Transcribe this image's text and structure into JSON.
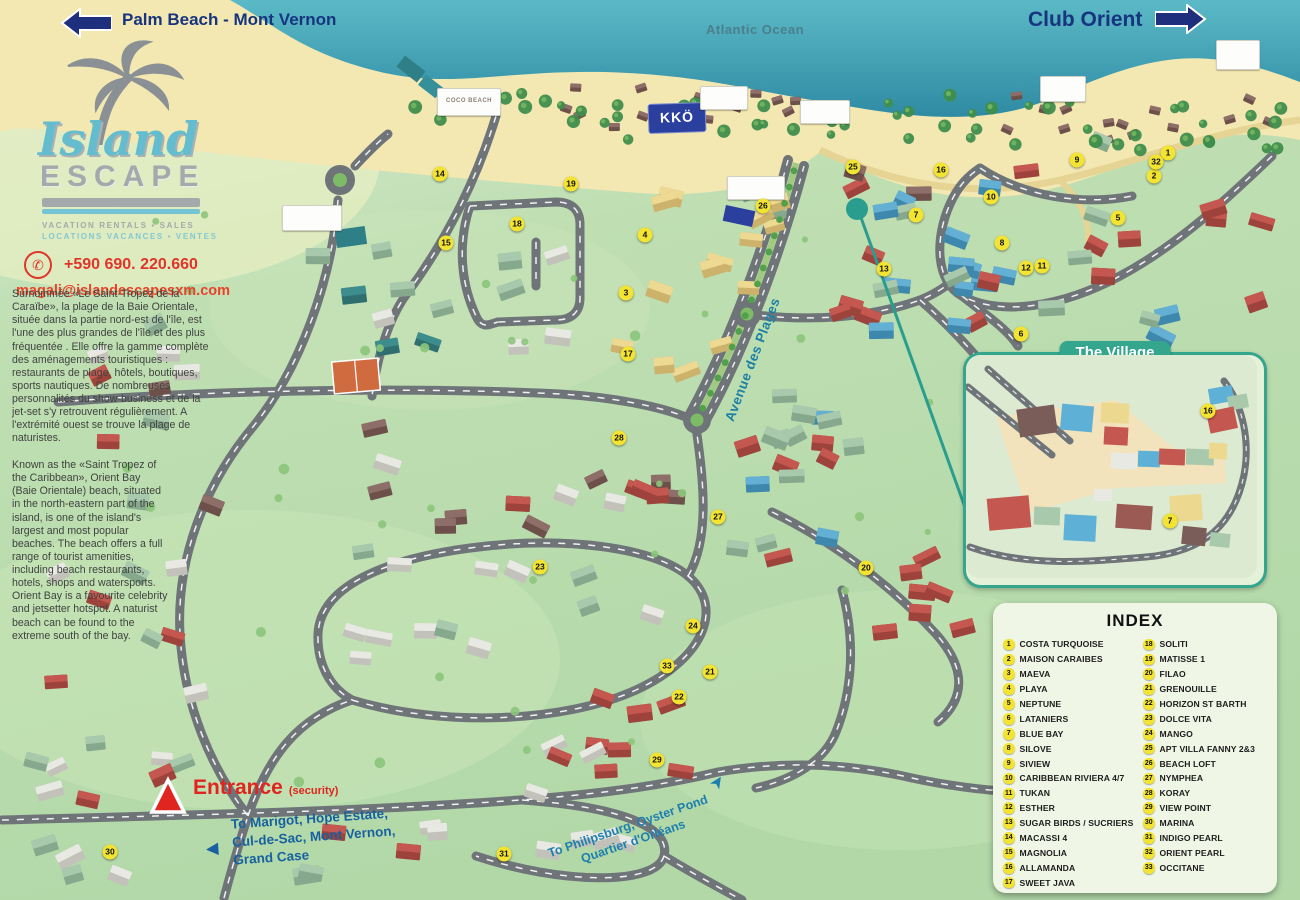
{
  "header": {
    "palm_beach": "Palm Beach - Mont Vernon",
    "atlantic_ocean": "Atlantic Ocean",
    "club_orient": "Club Orient"
  },
  "brand": {
    "name_top": "Island",
    "name_bottom": "ESCAPE",
    "tagline_en": "VACATION RENTALS ▪ SALES",
    "tagline_fr": "LOCATIONS VACANCES ▪ VENTES",
    "phone": "+590 690. 220.660",
    "email": "magali@islandescapesxm.com",
    "description_fr": "Surnommée «Le Saint-Tropez de la Caraïbe», la plage de la Baie Orientale, située dans la partie nord-est de l'île, est l'une des plus grandes de l'île et des plus fréquentée . Elle offre la gamme complète des aménagements touristiques : restaurants de plage, hôtels, boutiques, sports nautiques. De nombreuses personnalités du show-business et de la jet-set s'y retrouvent régulièrement. A l'extrémité ouest se trouve la plage de naturistes.",
    "description_en": "Known as the «Saint Tropez of the Caribbean», Orient Bay (Baie Orientale) beach, situated in the north-eastern part of the island, is one of the island's largest and most popular beaches. The beach offers a full range of tourist amenities, including beach restaurants, hotels, shops and watersports. Orient Bay is a favourite celebrity and jetsetter hotspot. A naturist beach can be found to the extreme south of the bay."
  },
  "map_labels": {
    "avenue": "Avenue des Plages",
    "entrance": "Entrance",
    "security": "(security)",
    "kko_sign": "KKÖ",
    "coco_beach_sign": "COCO BEACH",
    "to_marigot_lines": [
      "To Marigot, Hope Estate,",
      "Cul-de-Sac, Mont Vernon,",
      "Grand Case"
    ],
    "to_philipsburg_lines": [
      "To Philipsburg, Oyster Pond",
      "Quartier d'Orléans"
    ]
  },
  "village": {
    "title": "The Village",
    "markers": [
      {
        "n": 16,
        "x": 1208,
        "y": 411
      },
      {
        "n": 7,
        "x": 1170,
        "y": 521
      }
    ]
  },
  "index": {
    "title": "INDEX",
    "entries": [
      {
        "n": 1,
        "label": "COSTA TURQUOISE"
      },
      {
        "n": 2,
        "label": "MAISON CARAIBES"
      },
      {
        "n": 3,
        "label": "MAEVA"
      },
      {
        "n": 4,
        "label": "PLAYA"
      },
      {
        "n": 5,
        "label": "NEPTUNE"
      },
      {
        "n": 6,
        "label": "LATANIERS"
      },
      {
        "n": 7,
        "label": "BLUE BAY"
      },
      {
        "n": 8,
        "label": "SILOVE"
      },
      {
        "n": 9,
        "label": "SIVIEW"
      },
      {
        "n": 10,
        "label": "CARIBBEAN RIVIERA 4/7"
      },
      {
        "n": 11,
        "label": "TUKAN"
      },
      {
        "n": 12,
        "label": "ESTHER"
      },
      {
        "n": 13,
        "label": "SUGAR BIRDS / SUCRIERS"
      },
      {
        "n": 14,
        "label": "MACASSI 4"
      },
      {
        "n": 15,
        "label": "MAGNOLIA"
      },
      {
        "n": 16,
        "label": "ALLAMANDA"
      },
      {
        "n": 17,
        "label": "SWEET JAVA"
      },
      {
        "n": 18,
        "label": "SOLITI"
      },
      {
        "n": 19,
        "label": "MATISSE 1"
      },
      {
        "n": 20,
        "label": "FILAO"
      },
      {
        "n": 21,
        "label": "GRENOUILLE"
      },
      {
        "n": 22,
        "label": "HORIZON ST BARTH"
      },
      {
        "n": 23,
        "label": "DOLCE VITA"
      },
      {
        "n": 24,
        "label": "MANGO"
      },
      {
        "n": 25,
        "label": "APT VILLA FANNY 2&3"
      },
      {
        "n": 26,
        "label": "BEACH LOFT"
      },
      {
        "n": 27,
        "label": "NYMPHEA"
      },
      {
        "n": 28,
        "label": "KORAY"
      },
      {
        "n": 29,
        "label": "VIEW POINT"
      },
      {
        "n": 30,
        "label": "MARINA"
      },
      {
        "n": 31,
        "label": "INDIGO PEARL"
      },
      {
        "n": 32,
        "label": "ORIENT PEARL"
      },
      {
        "n": 33,
        "label": "OCCITANE"
      }
    ]
  },
  "markers": [
    {
      "n": 1,
      "x": 1168,
      "y": 153
    },
    {
      "n": 2,
      "x": 1154,
      "y": 176
    },
    {
      "n": 3,
      "x": 626,
      "y": 293
    },
    {
      "n": 4,
      "x": 645,
      "y": 235
    },
    {
      "n": 5,
      "x": 1118,
      "y": 218
    },
    {
      "n": 6,
      "x": 1021,
      "y": 334
    },
    {
      "n": 7,
      "x": 916,
      "y": 215
    },
    {
      "n": 8,
      "x": 1002,
      "y": 243
    },
    {
      "n": 9,
      "x": 1077,
      "y": 160
    },
    {
      "n": 10,
      "x": 991,
      "y": 197
    },
    {
      "n": 11,
      "x": 1042,
      "y": 266
    },
    {
      "n": 12,
      "x": 1026,
      "y": 268
    },
    {
      "n": 13,
      "x": 884,
      "y": 269
    },
    {
      "n": 14,
      "x": 440,
      "y": 174
    },
    {
      "n": 15,
      "x": 446,
      "y": 243
    },
    {
      "n": 16,
      "x": 941,
      "y": 170
    },
    {
      "n": 17,
      "x": 628,
      "y": 354
    },
    {
      "n": 18,
      "x": 517,
      "y": 224
    },
    {
      "n": 19,
      "x": 571,
      "y": 184
    },
    {
      "n": 20,
      "x": 866,
      "y": 568
    },
    {
      "n": 21,
      "x": 710,
      "y": 672
    },
    {
      "n": 22,
      "x": 679,
      "y": 697
    },
    {
      "n": 23,
      "x": 540,
      "y": 567
    },
    {
      "n": 24,
      "x": 693,
      "y": 626
    },
    {
      "n": 25,
      "x": 853,
      "y": 167
    },
    {
      "n": 26,
      "x": 763,
      "y": 206
    },
    {
      "n": 27,
      "x": 718,
      "y": 517
    },
    {
      "n": 28,
      "x": 619,
      "y": 438
    },
    {
      "n": 29,
      "x": 657,
      "y": 760
    },
    {
      "n": 30,
      "x": 110,
      "y": 852
    },
    {
      "n": 31,
      "x": 504,
      "y": 854
    },
    {
      "n": 32,
      "x": 1156,
      "y": 162
    },
    {
      "n": 33,
      "x": 667,
      "y": 666
    }
  ],
  "colors": {
    "navy": "#16357e",
    "accent_teal": "#2a9d8f",
    "marker_yellow": "#f2e431",
    "red": "#e0241f",
    "road_gray": "#6e7477",
    "sea": "#3898ad",
    "sand": "#f3e7b2",
    "land": "#b9dcae"
  }
}
